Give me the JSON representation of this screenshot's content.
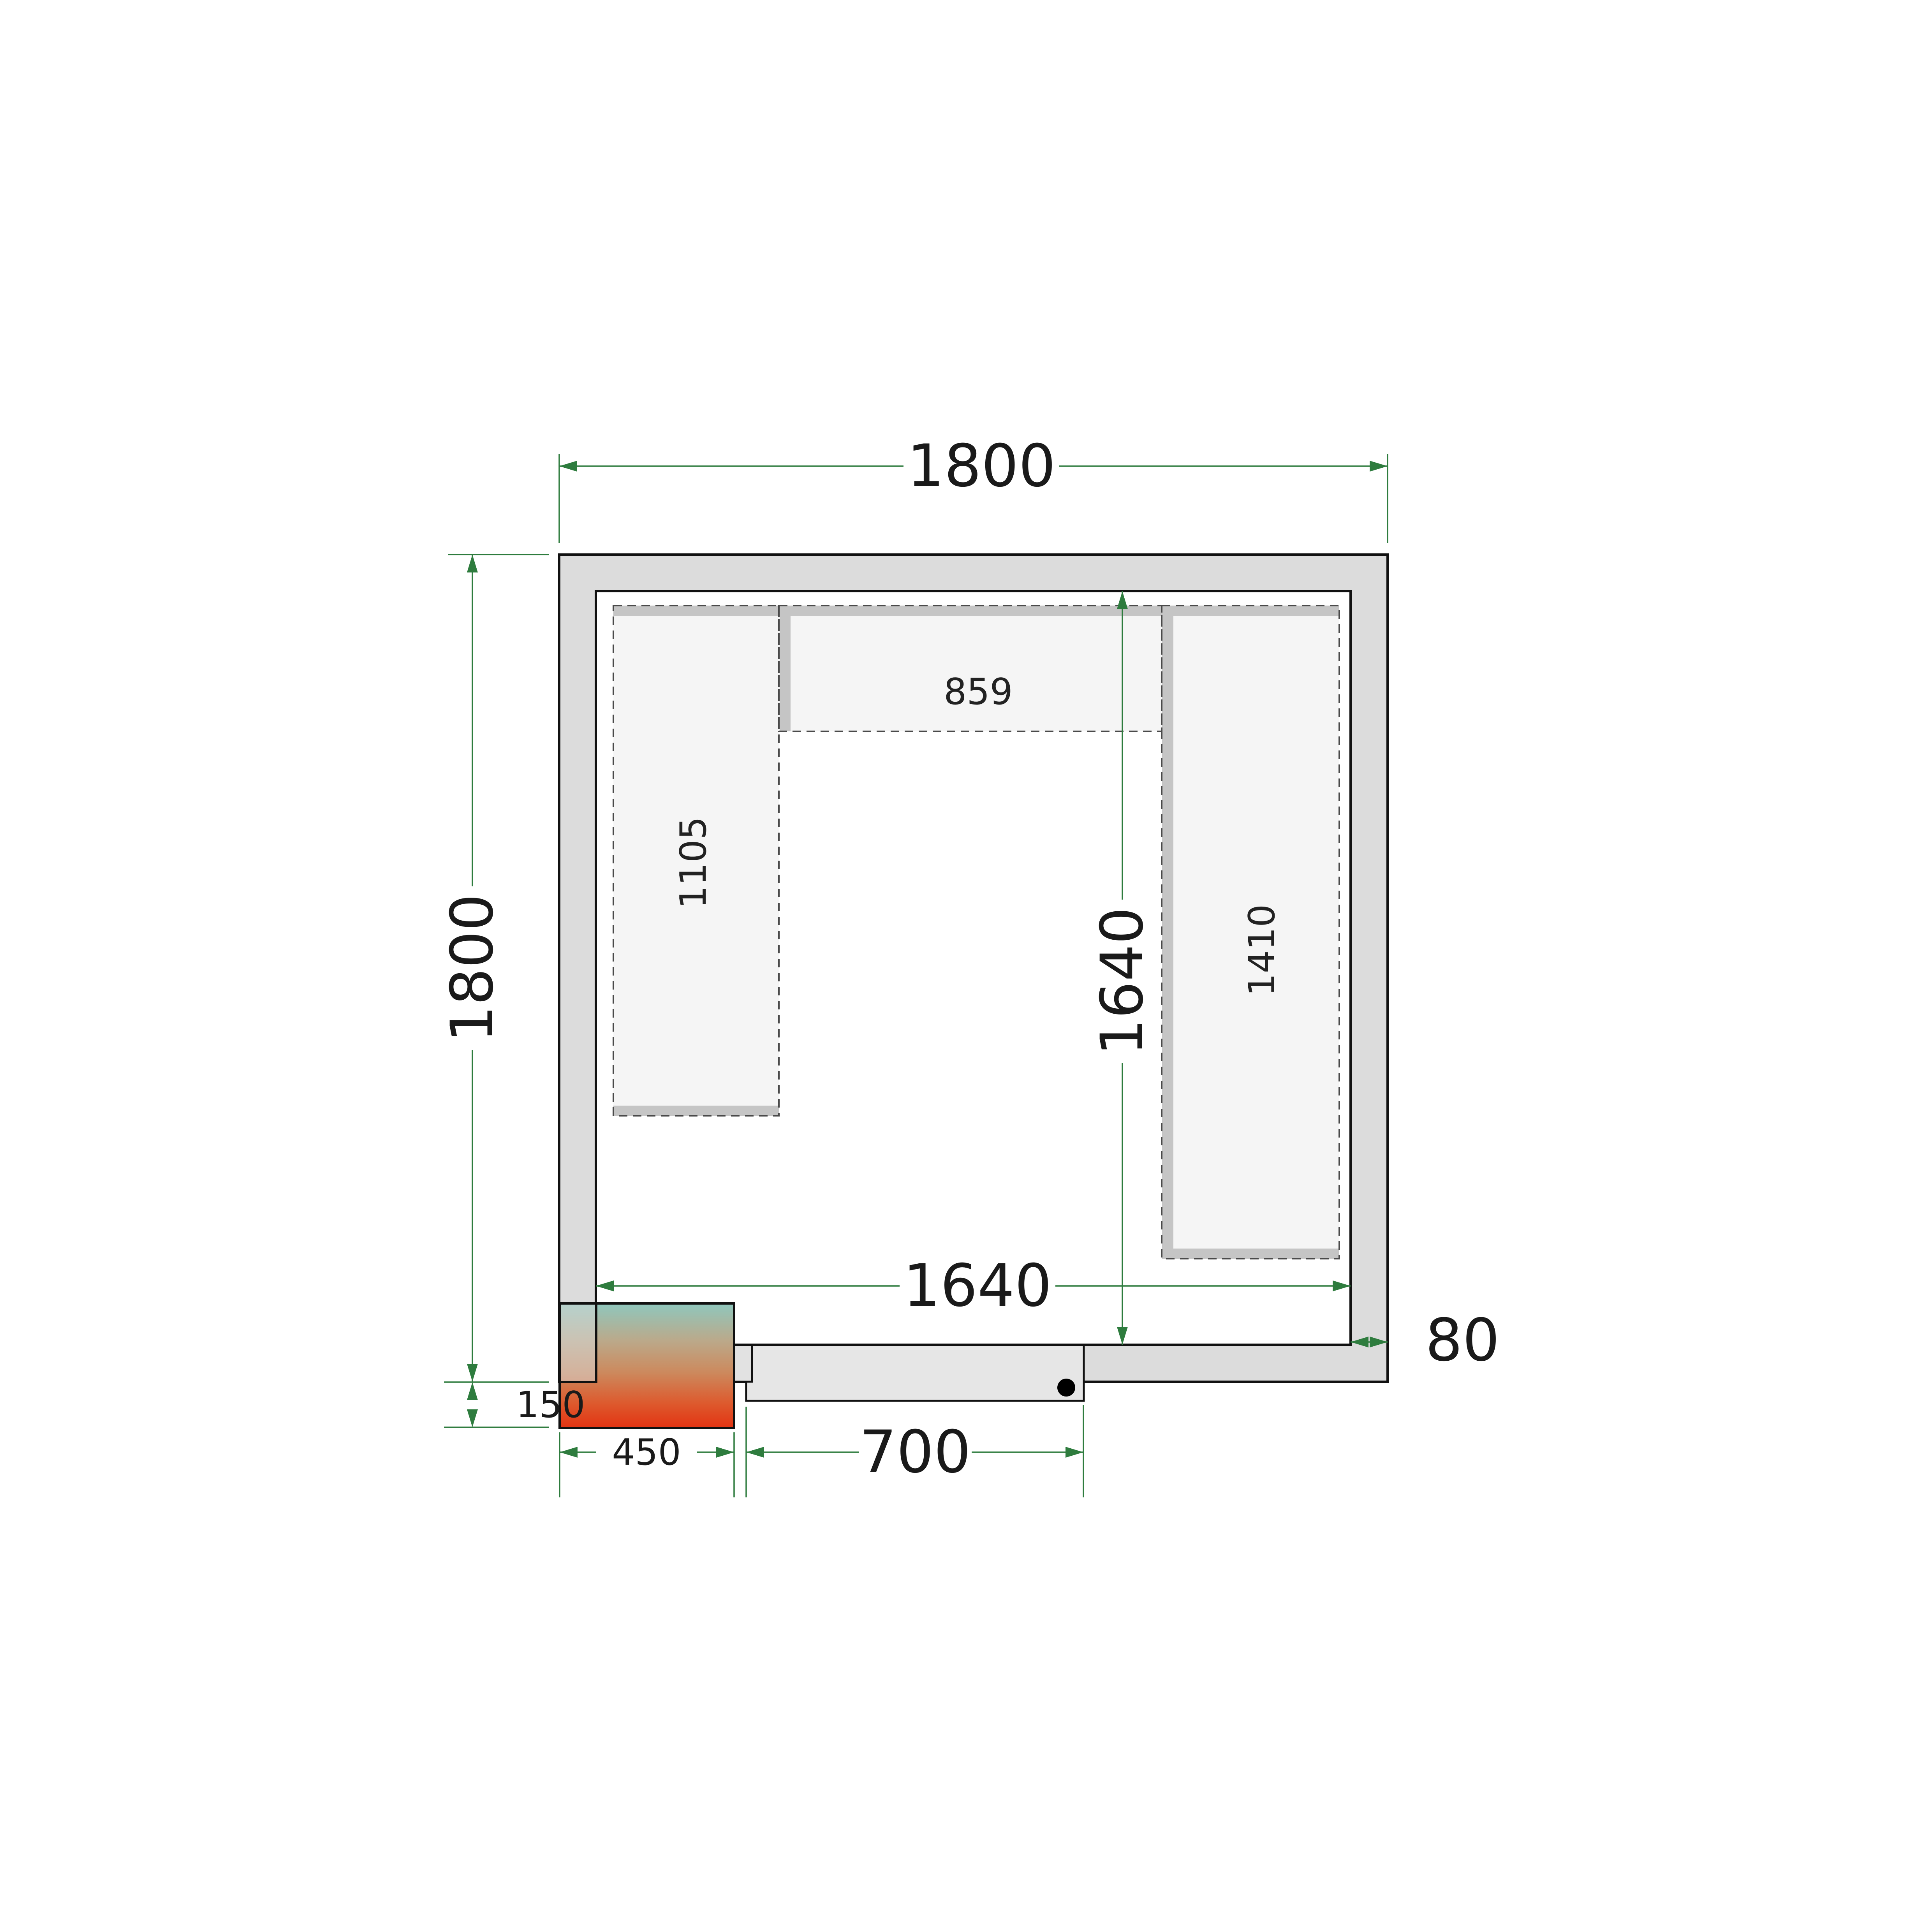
{
  "diagram": {
    "type": "cold-room floor plan, top view",
    "dimensions": {
      "outer_width": "1800",
      "outer_height": "1800",
      "inner_width": "1640",
      "inner_height": "1640",
      "door_width": "700",
      "cooling_unit_width": "450",
      "cooling_unit_offset": "150",
      "wall_thickness": "80"
    },
    "shelves": {
      "top_shelf_length": "859",
      "left_shelf_length": "1105",
      "right_shelf_length": "1410"
    },
    "colors": {
      "dimension_green": "#2e7c3e",
      "wall_fill": "#dcdcdc",
      "door_fill": "#e6e6e6",
      "shelf_fill": "#f5f5f5",
      "shelf_support_gray": "#c5c5c5",
      "dashed_outline": "#4a4a4a",
      "unit_gradient_top": "#8fc7bd",
      "unit_gradient_bottom": "#e33312"
    }
  }
}
